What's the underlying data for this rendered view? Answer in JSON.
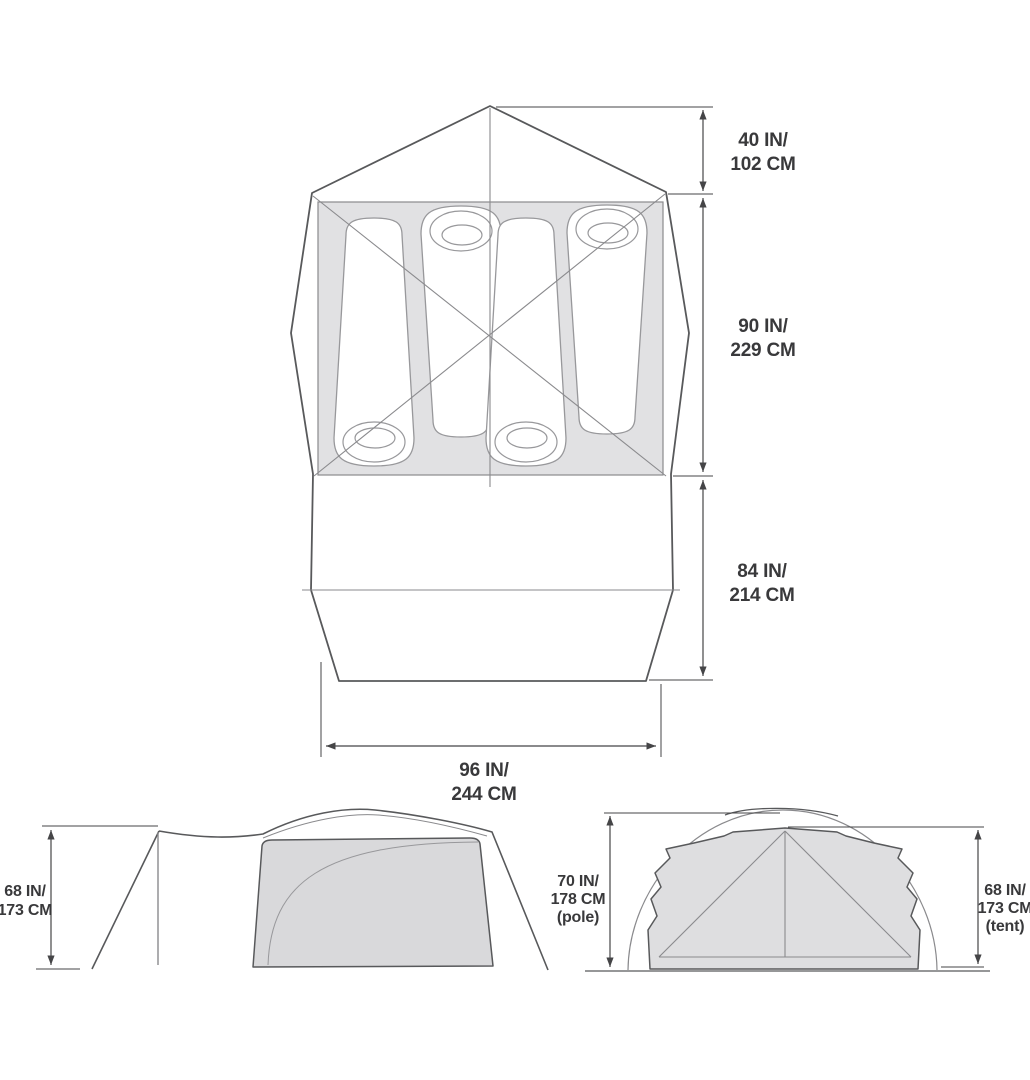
{
  "diagram": {
    "type": "tent-dimension-specification",
    "views": {
      "top": {
        "dimensions": [
          {
            "id": "vestibule-depth",
            "lines": [
              "40 IN/",
              "102 CM"
            ]
          },
          {
            "id": "sleeping-floor-length",
            "lines": [
              "90 IN/",
              "229 CM"
            ]
          },
          {
            "id": "porch-length",
            "lines": [
              "84 IN/",
              "214 CM"
            ]
          },
          {
            "id": "floor-width",
            "lines": [
              "96 IN/",
              "244 CM"
            ]
          }
        ],
        "sleeping_pad_count": 4
      },
      "side": {
        "dimensions": [
          {
            "id": "side-height",
            "lines": [
              "68 IN/",
              "173 CM"
            ]
          }
        ]
      },
      "front": {
        "dimensions": [
          {
            "id": "pole-height",
            "lines": [
              "70 IN/",
              "178 CM",
              "(pole)"
            ]
          },
          {
            "id": "tent-height",
            "lines": [
              "68 IN/",
              "173 CM",
              "(tent)"
            ]
          }
        ]
      }
    }
  },
  "colors": {
    "line": "#58595b",
    "thin_line": "#8a8a8d",
    "dimension_line": "#454547",
    "text": "#39393b",
    "floor_fill": "#e1e1e3",
    "panel_fill": "#d9d9db",
    "front_fill": "#dedee0",
    "pad_stroke": "#98989b",
    "background": "#ffffff"
  }
}
